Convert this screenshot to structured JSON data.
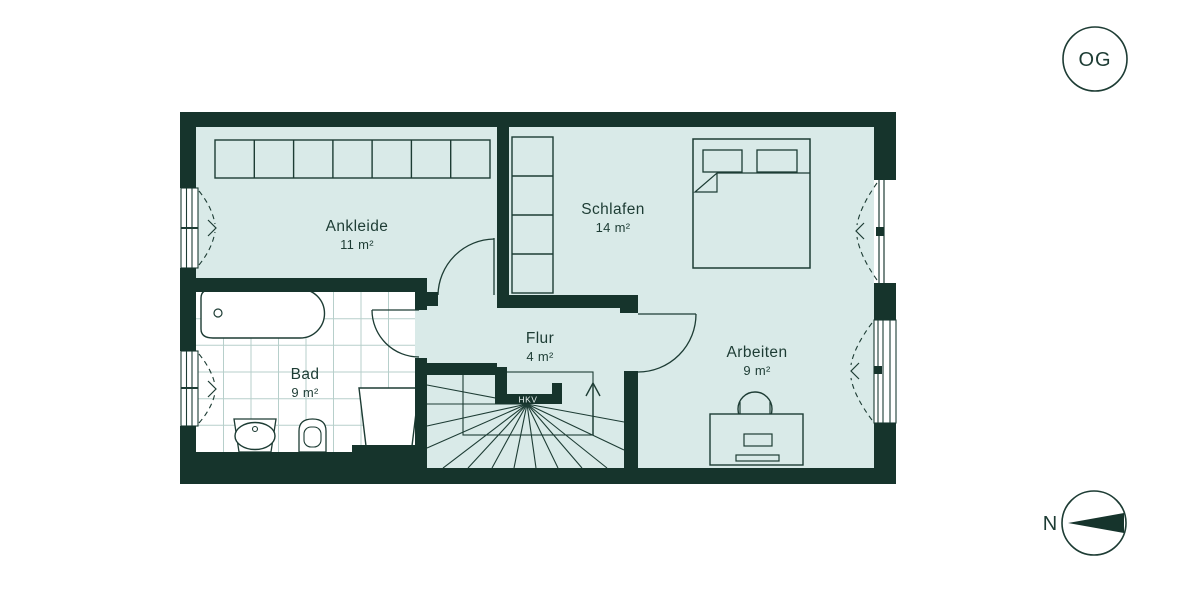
{
  "floor_badge": "OG",
  "compass": {
    "north_label": "N"
  },
  "rooms": [
    {
      "name": "Ankleide",
      "area": "11 m²"
    },
    {
      "name": "Schlafen",
      "area": "14 m²"
    },
    {
      "name": "Flur",
      "area": "4 m²"
    },
    {
      "name": "Bad",
      "area": "9 m²"
    },
    {
      "name": "Arbeiten",
      "area": "9 m²"
    }
  ],
  "annotations": {
    "hkv": "HKV"
  },
  "colors": {
    "wall": "#16342c",
    "floor": "#d9eae8",
    "bath_floor": "#ffffff",
    "tile_line": "#b7cfcb",
    "ink": "#1d3c34",
    "background": "#ffffff"
  }
}
